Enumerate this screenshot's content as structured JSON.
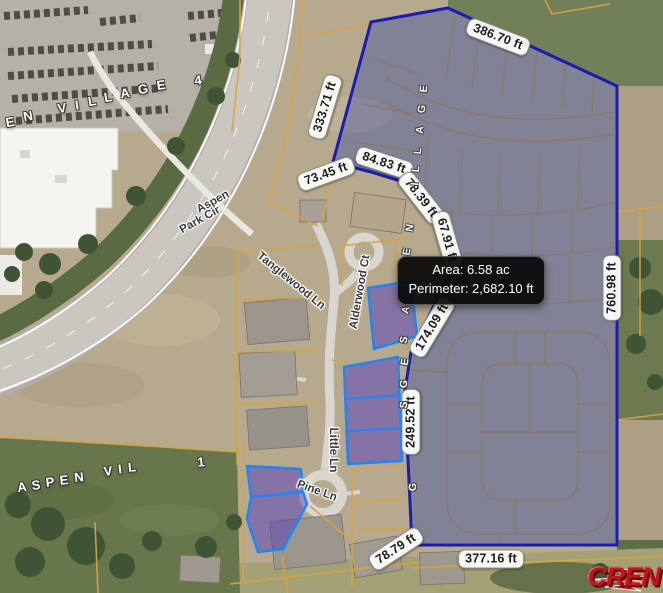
{
  "tooltip": {
    "line1": "Area: 6.58 ac",
    "line2": "Perimeter: 2,682.10 ft"
  },
  "logo": {
    "text": "CREN"
  },
  "selected_parcel": {
    "area": "6.58 ac",
    "perimeter": "2,682.10 ft"
  },
  "street_names": [
    "Aspen Park Cir",
    "Tanglewood Ln",
    "Alderwood Ct",
    "Little Ln",
    "Pine Ln"
  ],
  "subdivision_names": [
    "EN VILLAGE 4",
    "ASPEN VIL 1",
    "ASPEN VILLAGE"
  ],
  "colors": {
    "selection_fill": "#2842a5",
    "selection_border": "#1c1cb2",
    "highlight_parcel_border": "#1f86f5",
    "highlight_parcel_fill": "#5a46be",
    "parcel_line": "#d8a440",
    "logo_red": "#c0151b",
    "tooltip_bg": "#080808"
  },
  "labels": {
    "measurements": [
      {
        "text": "386.70 ft",
        "x": 498,
        "y": 37,
        "rot": 21
      },
      {
        "text": "333.71 ft",
        "x": 325,
        "y": 107,
        "rot": -73
      },
      {
        "text": "73.45 ft",
        "x": 326,
        "y": 174,
        "rot": -20
      },
      {
        "text": "84.83 ft",
        "x": 384,
        "y": 163,
        "rot": 18
      },
      {
        "text": "78.39 ft",
        "x": 421,
        "y": 198,
        "rot": 52
      },
      {
        "text": "67.91 ft",
        "x": 447,
        "y": 240,
        "rot": 74
      },
      {
        "text": "174.09 ft",
        "x": 432,
        "y": 327,
        "rot": -59
      },
      {
        "text": "249.52 ft",
        "x": 411,
        "y": 422,
        "rot": -90
      },
      {
        "text": "760.98 ft",
        "x": 612,
        "y": 288,
        "rot": -90
      },
      {
        "text": "78.79 ft",
        "x": 396,
        "y": 549,
        "rot": -33
      },
      {
        "text": "377.16 ft",
        "x": 491,
        "y": 559,
        "rot": 0
      }
    ],
    "streets": [
      {
        "text": "Aspen",
        "x": 213,
        "y": 202,
        "rot": -29
      },
      {
        "text": "Park Cir",
        "x": 200,
        "y": 220,
        "rot": -29
      },
      {
        "text": "Tanglewood Ln",
        "x": 291,
        "y": 281,
        "rot": 39
      },
      {
        "text": "Alderwood Ct",
        "x": 360,
        "y": 292,
        "rot": -80
      },
      {
        "text": "Little Ln",
        "x": 333,
        "y": 450,
        "rot": 90
      },
      {
        "text": "Pine Ln",
        "x": 317,
        "y": 491,
        "rot": 20
      }
    ],
    "area_letters": [
      {
        "text": "E",
        "x": 10,
        "y": 122,
        "rot": -10
      },
      {
        "text": "N",
        "x": 28,
        "y": 116,
        "rot": -10
      },
      {
        "text": "V",
        "x": 62,
        "y": 108,
        "rot": -9
      },
      {
        "text": "I",
        "x": 77,
        "y": 105,
        "rot": -9
      },
      {
        "text": "L",
        "x": 92,
        "y": 101,
        "rot": -9
      },
      {
        "text": "L",
        "x": 108,
        "y": 97,
        "rot": -9
      },
      {
        "text": "A",
        "x": 125,
        "y": 93,
        "rot": -8
      },
      {
        "text": "G",
        "x": 143,
        "y": 89,
        "rot": -8
      },
      {
        "text": "E",
        "x": 161,
        "y": 85,
        "rot": -8
      },
      {
        "text": "4",
        "x": 198,
        "y": 80,
        "rot": -8
      },
      {
        "text": "A",
        "x": 22,
        "y": 487,
        "rot": -7
      },
      {
        "text": "S",
        "x": 36,
        "y": 485,
        "rot": -7
      },
      {
        "text": "P",
        "x": 50,
        "y": 482,
        "rot": -7
      },
      {
        "text": "E",
        "x": 64,
        "y": 480,
        "rot": -6
      },
      {
        "text": "N",
        "x": 79,
        "y": 477,
        "rot": -6
      },
      {
        "text": "V",
        "x": 108,
        "y": 471,
        "rot": -6
      },
      {
        "text": "I",
        "x": 120,
        "y": 469,
        "rot": -6
      },
      {
        "text": "L",
        "x": 132,
        "y": 467,
        "rot": -5
      },
      {
        "text": "1",
        "x": 201,
        "y": 462,
        "rot": -5
      }
    ],
    "boundary_letters": [
      {
        "text": "E",
        "x": 424,
        "y": 89,
        "rot": -85
      },
      {
        "text": "G",
        "x": 422,
        "y": 109,
        "rot": -85
      },
      {
        "text": "A",
        "x": 420,
        "y": 130,
        "rot": -85
      },
      {
        "text": "L",
        "x": 418,
        "y": 151,
        "rot": -85
      },
      {
        "text": "L",
        "x": 416,
        "y": 169,
        "rot": -85
      },
      {
        "text": "I",
        "x": 415,
        "y": 184,
        "rot": -85
      },
      {
        "text": "N",
        "x": 410,
        "y": 228,
        "rot": -80
      },
      {
        "text": "E",
        "x": 407,
        "y": 252,
        "rot": -80
      },
      {
        "text": "A",
        "x": 406,
        "y": 310,
        "rot": -75
      },
      {
        "text": "S",
        "x": 404,
        "y": 340,
        "rot": -78
      },
      {
        "text": "E",
        "x": 405,
        "y": 362,
        "rot": -80
      },
      {
        "text": "G",
        "x": 404,
        "y": 384,
        "rot": -82
      },
      {
        "text": "S",
        "x": 404,
        "y": 405,
        "rot": -84
      },
      {
        "text": "G",
        "x": 413,
        "y": 487,
        "rot": -88
      }
    ]
  }
}
